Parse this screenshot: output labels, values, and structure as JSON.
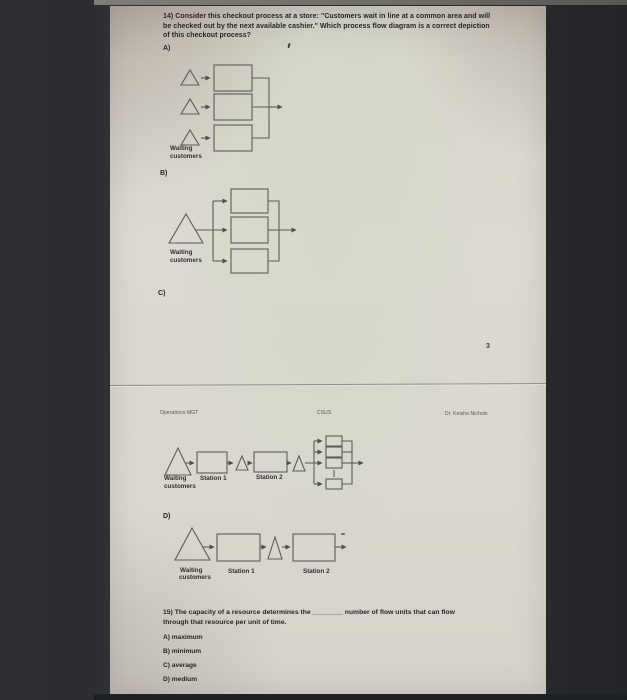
{
  "doc": {
    "page_number": "3",
    "header": {
      "left": "Operations MGT",
      "center": "CSUS",
      "right": "Dr. Keisha Nichols"
    },
    "q14": {
      "lines": [
        "14) Consider this checkout process at a store: \"Customers wait in line at a common area and will",
        "be checked out by the next available cashier.\" Which process flow diagram is a correct depiction",
        "of this checkout process?"
      ],
      "label_a": "A)",
      "label_b": "B)",
      "label_c": "C)",
      "label_d": "D)"
    },
    "labels": {
      "waiting_1": "Waiting",
      "waiting_2": "customers",
      "station_1": "Station 1",
      "station_2": "Station 2"
    },
    "q15": {
      "lines": [
        "15) The capacity of a resource determines the ________ number of flow units that can flow",
        "through that resource per unit of time."
      ],
      "options": [
        "A) maximum",
        "B) minimum",
        "C) average",
        "D) medium"
      ]
    }
  }
}
